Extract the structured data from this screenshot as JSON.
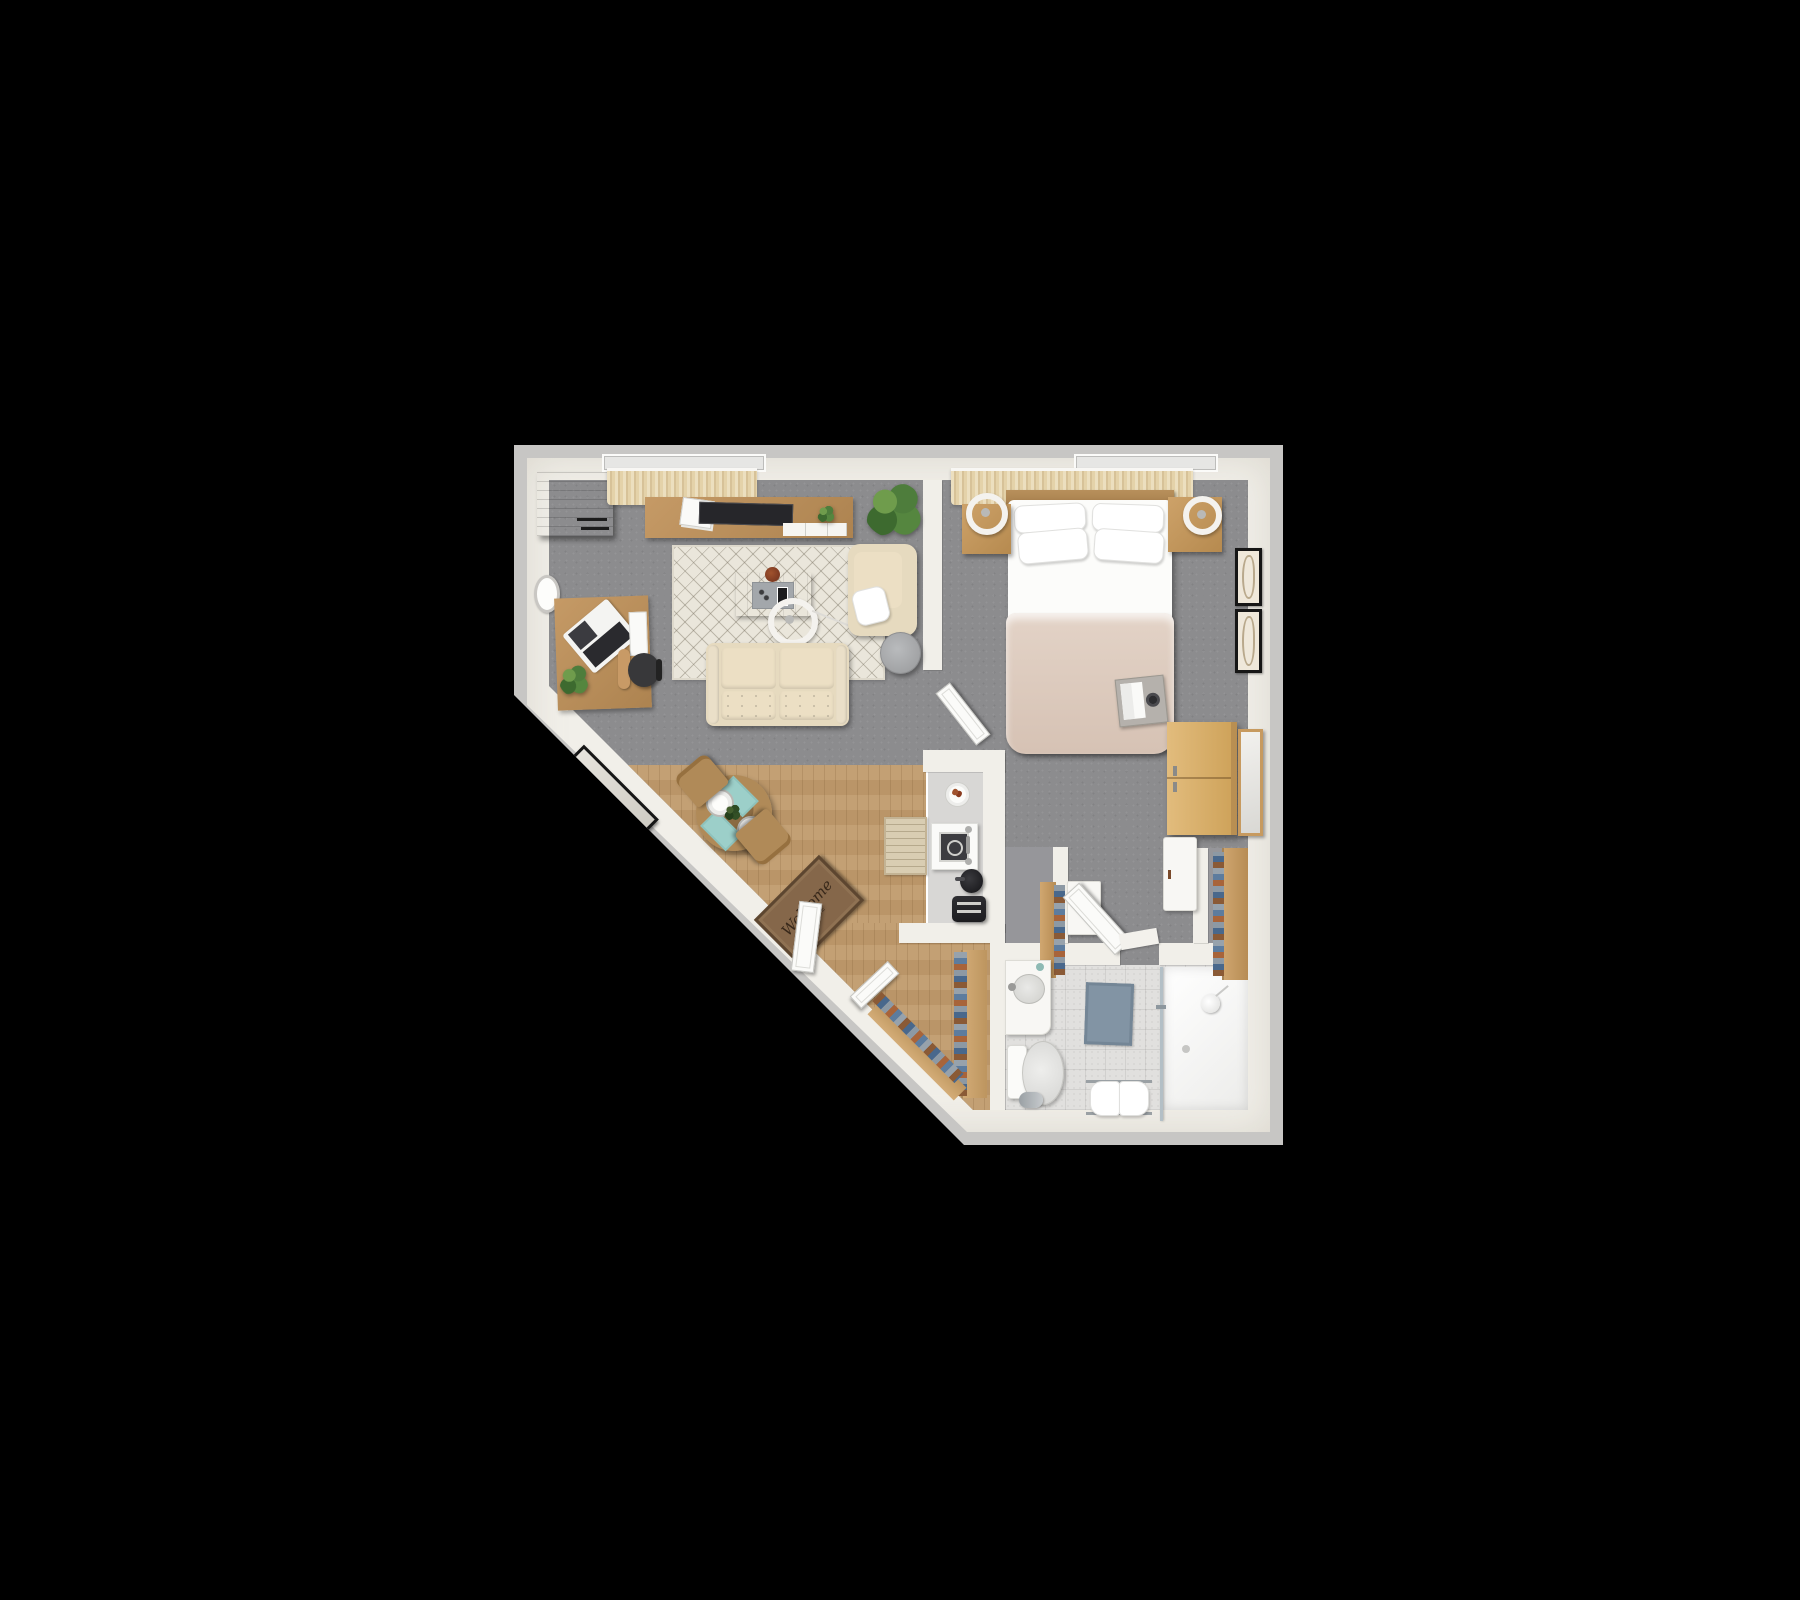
{
  "scene": {
    "type": "3d-floor-plan-top-view",
    "background": "#000000",
    "apartment_shape": "pentagon with 45-degree diagonal entry wall at lower left"
  },
  "welcome_mat": {
    "script": "Welcome",
    "caps": "HOME"
  },
  "palette": {
    "slab": "#c7c6c4",
    "wall": "#f1efe9",
    "carpet": "#8c8c8e",
    "wood_floor": "#c09b6d",
    "bath_tile": "#e1e0de",
    "shower_floor": "#f4f4f2",
    "rug": "#eae6db",
    "sofa": "#e6dabf",
    "wood_furniture": "#b98d5e",
    "wardrobe": "#d9b26f",
    "blanket": "#dbc9bd",
    "shower_mat": "#8294a4",
    "placemat": "#9ccfc9",
    "kitchen_counter": "#d8d7d5"
  },
  "rooms": {
    "living_room": {
      "floor": "gray carpet",
      "furniture": [
        "corner storage cabinet",
        "window curtains",
        "tv console with tv and magazines",
        "potted plants",
        "wall clock",
        "desk with laptop",
        "office chair",
        "area rug",
        "coffee table with tray and bowl",
        "arc floor lamp",
        "two-seat sofa",
        "armchair with pillow",
        "round side table"
      ]
    },
    "dining_area": {
      "floor": "wood planks",
      "furniture": [
        "leaning floor mirror",
        "round dining table",
        "two dining chairs",
        "two place settings with teal placemats",
        "welcome mat",
        "open front door"
      ]
    },
    "kitchen": {
      "floor": "light counter strip",
      "furniture": [
        "serving plate",
        "sink-cooktop unit with faucet",
        "kettle",
        "toaster",
        "runner rug"
      ]
    },
    "bedroom": {
      "floor": "gray carpet",
      "furniture": [
        "window curtains",
        "double bed with four pillows and tan blanket",
        "breakfast tray with book",
        "two nightstands",
        "two ring pendant lamps",
        "two framed wall art",
        "wardrobe",
        "leaning mirror",
        "white wall cabinets",
        "shoe shelf niches",
        "open bedroom door"
      ]
    },
    "walk_in_closet": {
      "floor": "wood planks",
      "furniture": [
        "hanging clothes on two rails",
        "closet door"
      ]
    },
    "bathroom": {
      "floor": "tile",
      "furniture": [
        "vanity with round sink",
        "toilet",
        "paper holder",
        "shower mat",
        "towel bench with two towels",
        "glass shower panel",
        "walk-in shower with shower head"
      ]
    }
  }
}
